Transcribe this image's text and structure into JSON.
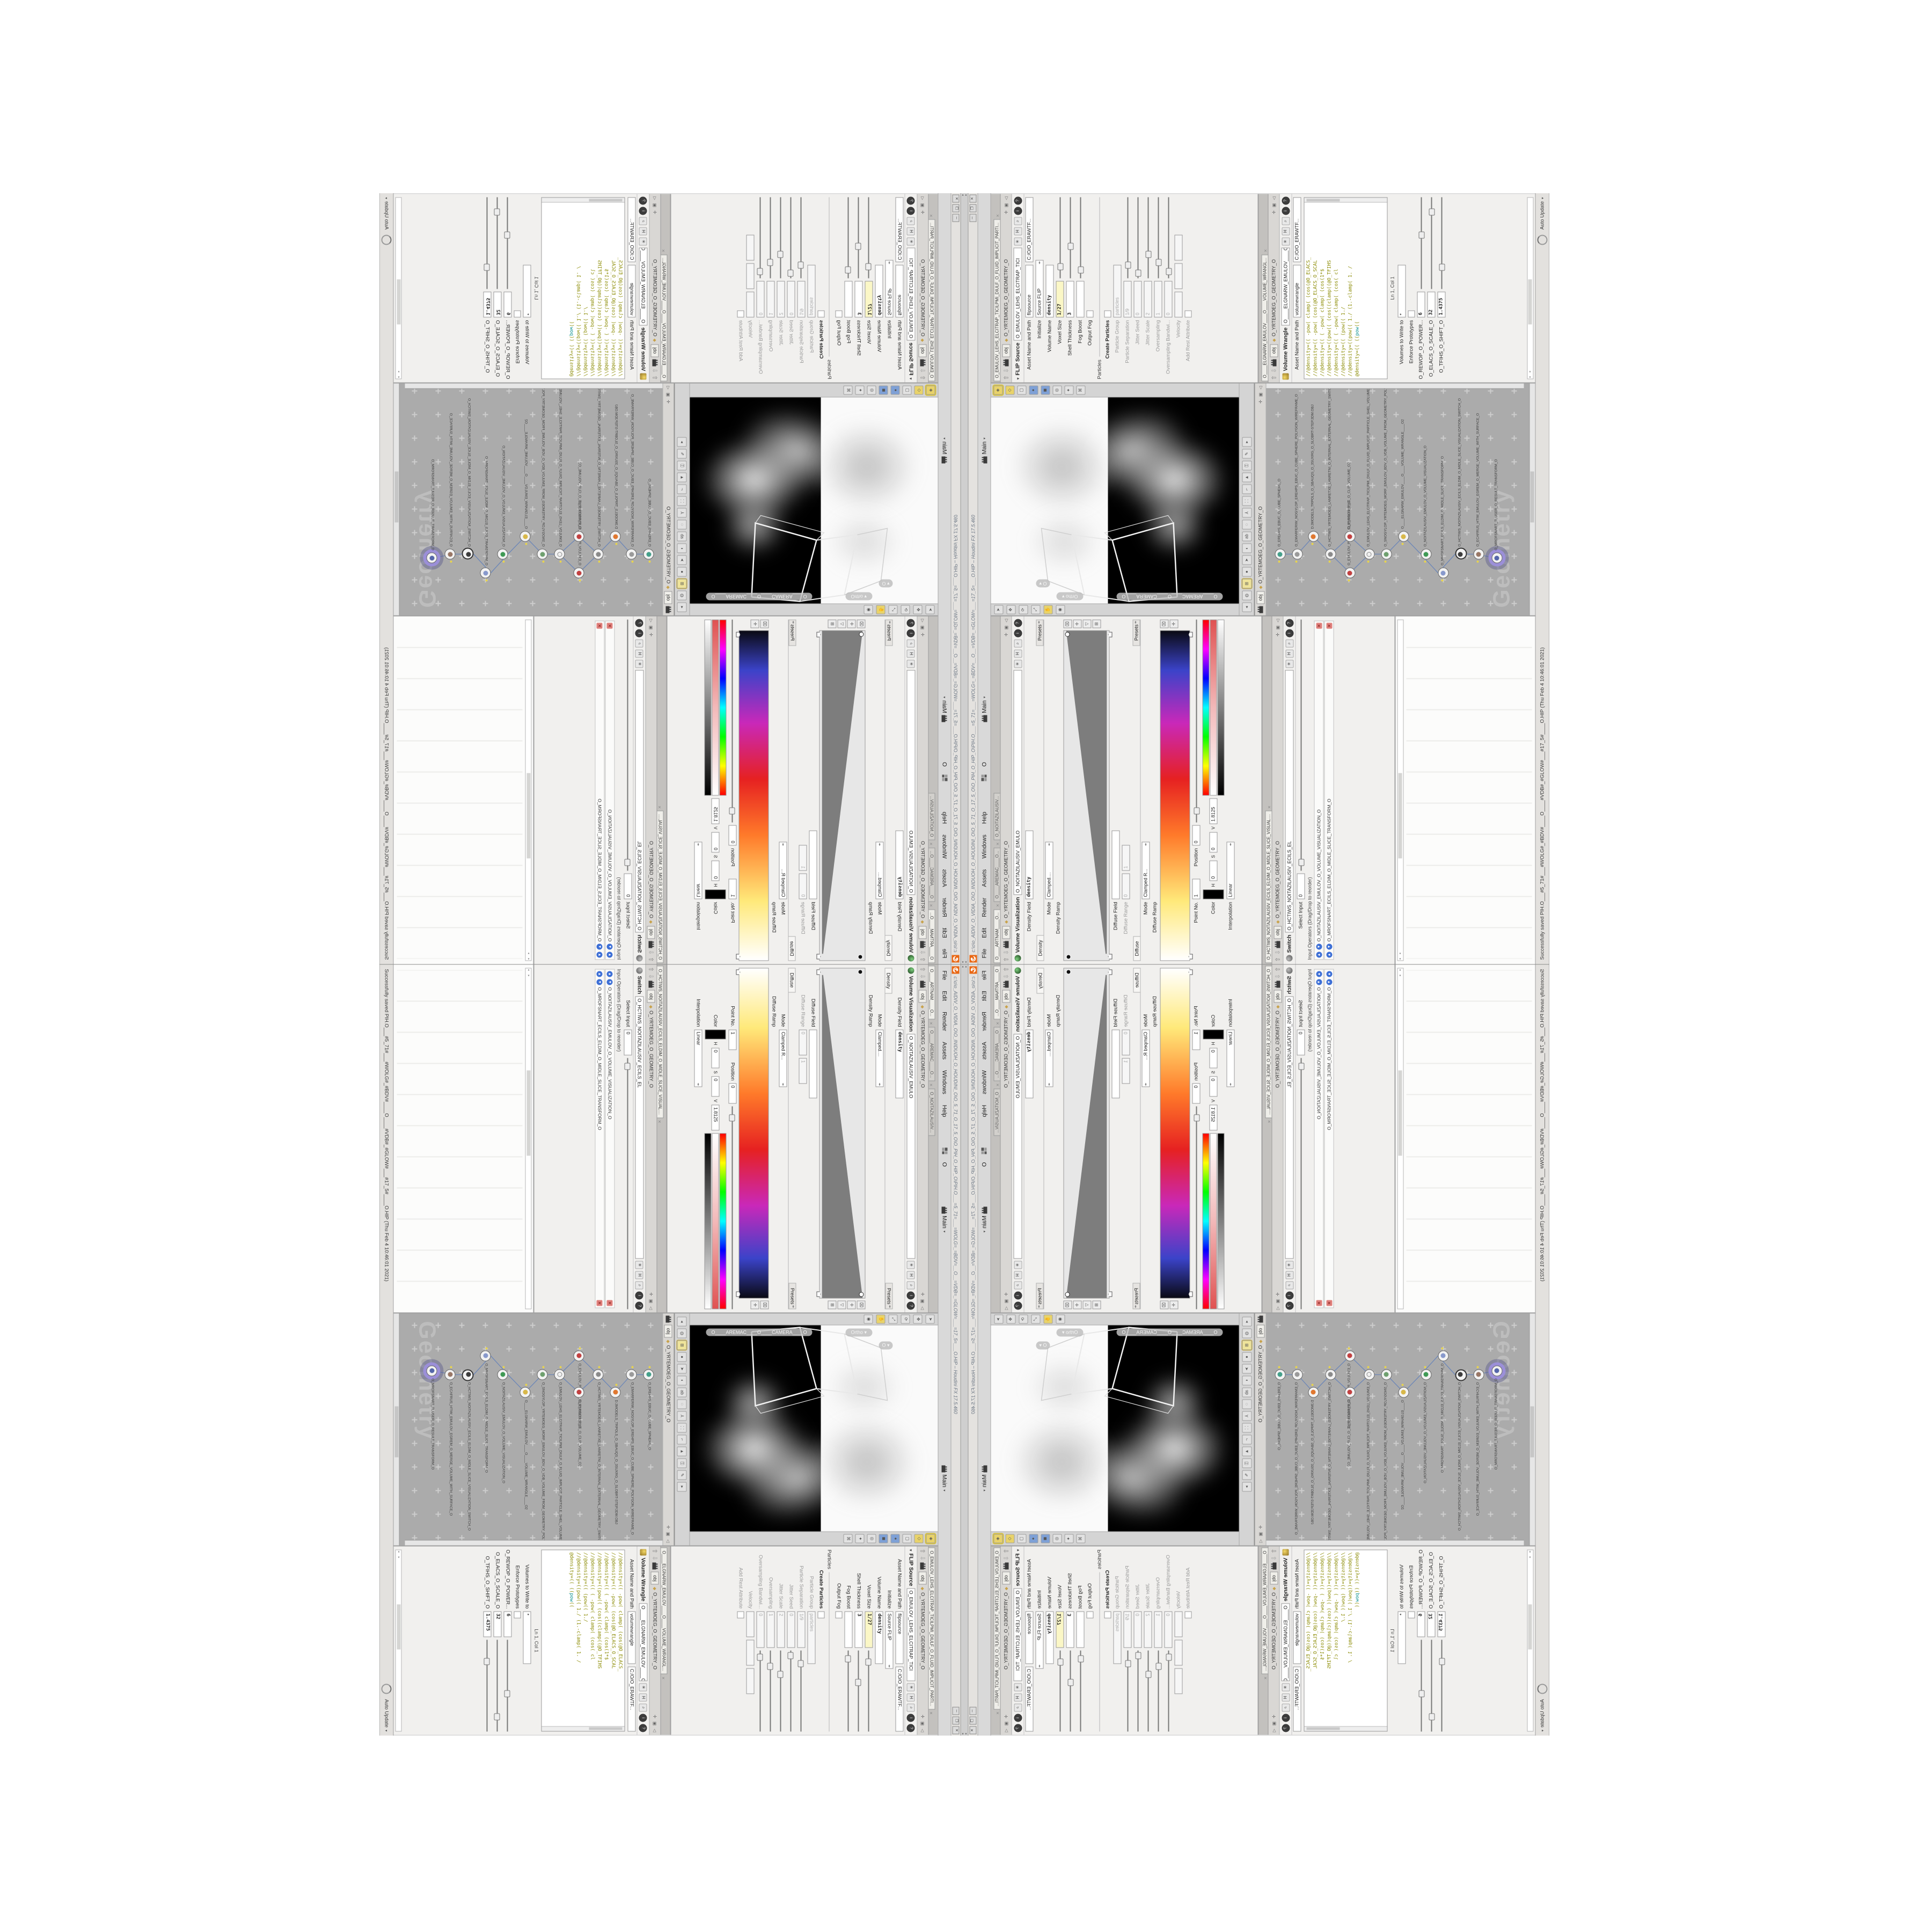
{
  "colors": {
    "accent_orange": "#e96713",
    "selected_node_purple": "#9b8fd8",
    "flag_yellow": "#e8d44d",
    "code_olive": "#8a8a00",
    "code_keyword_teal": "#008b8b",
    "expression_field_yellow": "#fbf7c6",
    "panel_gray": "#d9d9d9",
    "network_bg": "#ababab"
  },
  "window": {
    "title": "c:\\o\\o_AIDIV_O_VIDIA_O\\O_INIDUOH_O_HOUDINI_O\\O_5_71_O_17_5_O\\O_PIH_O_HIP_O\\PIH.O___=5_71=___=WOLG=_=BDV=__O__=VDB=_=GLOW=___=17_5=___O.HIP – Houdini FX 17.5.460",
    "menus": [
      "File",
      "Edit",
      "Render",
      "Assets",
      "Windows",
      "Help"
    ],
    "grid_label": "O",
    "desktop_label": "Main",
    "win_min": "─",
    "win_max": "❐",
    "win_close": "✕"
  },
  "status": {
    "message": "Successfully saved PIH.O___#5_71#___#WOLG#_#BDV#____O____#VDB#_#GLOW#___#17_5#____O.HIP (Thu Feb 4 10:46:01 2021)",
    "auto_update": "Auto Update"
  },
  "breadcrumb": {
    "root": "obj",
    "path": "O_YRTEMOEG_O_GEOMETRY_O"
  },
  "left_tabs": {
    "tab1": "O____ARTNAM____O...",
    "tab2": "O____AREMAC____O...",
    "tab3": "O_NOITAZILAUSIV..."
  },
  "volvis": {
    "title": "Volume Visualization",
    "name": "O_NOITAZILAUSIV_EMULO",
    "density_field_label": "Density Field",
    "density_field": "density",
    "mode_label": "Mode",
    "mode": "Clamped....",
    "folder_density": "Density",
    "folder_diffuse": "Diffuse",
    "presets": "Presets",
    "density_ramp_label": "Density Ramp",
    "diffuse_field_label": "Diffuse Field",
    "diffuse_field": "",
    "diffuse_range_label": "Diffuse Range",
    "range_min": "0",
    "range_max": "1",
    "mode2": "Clamped R...",
    "diffuse_ramp_label": "Diffuse Ramp",
    "point_label": "Point No.",
    "point": "1",
    "position_label": "Position",
    "position": "0",
    "color_label": "Color",
    "h_label": "H",
    "h": "0",
    "s_label": "S",
    "s": "0",
    "v_label": "V",
    "v": "1.8125",
    "interp_label": "Interpolation",
    "interp": "Linear"
  },
  "switch_pane": {
    "tab": "O_HCTIWS_NOITAZILAUSIV_ECILS_ELDIM_O_MIDLE_SLICE_VISUAL....",
    "title": "Switch",
    "name": "O_HCTIWS_NOITAZILAUSIV_ECILS_EL",
    "select_label": "Select Input",
    "select_value": "0",
    "list_header": "Input Operators (Drag/Drop to reorder)",
    "item1": "O_NOITAZILAUSIV_EMULOV_O_VOLUME_VISUALIZATION_O",
    "item2": "O_MROFSNART_ECILS_ELDIM_O_MIDLE_SLICE_TRANSFORM_O"
  },
  "flip": {
    "tab": "O_EMULOV_LEHS_ELCITRAP_TICILPMI_DIULF_O_FLUID_IMPLICIT_PARTI...",
    "title": "FLIP Source",
    "name": "O_EMULOV_LEHS_ELCITRAP_TICI",
    "asset_label": "Asset Name and Path",
    "node_name": "flipsource",
    "path": "C:/O/O_ERAWTF...",
    "initialize_label": "Initialize",
    "initialize": "Source FLIP",
    "volume_name_label": "Volume Name",
    "volume_name": "density",
    "voxel_label": "Voxel Size",
    "voxel": "1/27",
    "shell_label": "Shell Thickness",
    "shell": "3",
    "fog_label": "Fog Boost",
    "fog": "",
    "output_fog_label": "Output Fog",
    "particles_section": "Particles",
    "create_particles_label": "Create Particles",
    "group_label": "Particle Group",
    "group": "particles",
    "sep_label": "Particle Separation",
    "sep": "1/9",
    "jseed_label": "Jitter Seed",
    "jseed": "0",
    "jscale_label": "Jitter Scale",
    "jscale": "2",
    "over_label": "Oversampling",
    "over": "1",
    "overb_label": "Oversampling Bandwi...",
    "overb": "0",
    "velocity_label": "Velocity",
    "rest_label": "Add Rest Attribute"
  },
  "wrangle": {
    "tab": "O____ELGNARW_EMULOV____O____VOLUME_WRANGL...",
    "title": "Volume Wrangle",
    "name": "O____ELGNARW_EMULOV____O",
    "asset_label": "Asset Name and Path",
    "node_name": "volumewrangle",
    "path": "C:/O/O_ERAWTF...",
    "code": [
      "//@density=((      -pow(   clamp(  (cos(@O_ELACS_",
      "//@density=((      -pow(        (cos(@O_ELACS_O_SCAL",
      "//@density=((   (  -pow(   clamp(  (cos(1*$",
      "//@density=((pow((      (cos((clamp((@O_TFIHS",
      "//@density=((   (  -pow(   clamp(   (cos( cl",
      "//@density=((            (pow((        1./",
      "//@density=((pow((   1./ (1.-clamp(      1. /"
    ],
    "code_active_pre": "@density=((  ((",
    "code_active_kw": "pow",
    "code_active_post": "((",
    "cursor_pos": "Ln 1, Col 1",
    "volumes_label": "Volumes to Write to",
    "volumes": "*",
    "enforce_label": "Enforce Prototypes",
    "power_label": "O_REWOP_O_POWER...",
    "power": "6",
    "scale_label": "O_ELACS_O_SCALE_O",
    "scale": "32",
    "shift_label": "O_TFIHS_O_SHIFT_O",
    "shift": "1.4375"
  },
  "viewport": {
    "camera_pill": "O____AREMAC____O____CAMERA____O",
    "ortho_pill": "Ortho ▾",
    "mini_pill": "O ▾"
  },
  "network": {
    "watermark": "Geometry",
    "nodes": [
      {
        "type": "an_CubeSphere",
        "label": "O_EREHPS_EBUC_O_CUBE_SPHERE_O",
        "color": "#44a08a"
      },
      {
        "type": "PolyWire",
        "label": "O_EMARFERIW_NOGYLOP_EREHPS_EBUC_O_CUBE_SPHERE_POLYGON_WIREFRAME_O",
        "color": "#9a9a9a"
      },
      {
        "type": "File",
        "label": "D.3MODELS_TRPOLS_O_SBAUQS_O_3SUXRG_O_SLOBRT-STEP.3DM.OBJ",
        "color": "#e07830"
      },
      {
        "type": "Switch",
        "label": "O_HCTIWS_YRTEMOEG_LANRETXE_LANRETNI_O_INTERNAL_EXTERNAL_GEOMETRY_SWITCH_O",
        "color": "#8a8a8a"
      },
      {
        "type": "Clip",
        "label": "O_EMULOV_PILC_O_CLIP_VOLUME_O",
        "color": "#c24040"
      },
      {
        "type": "Clip",
        "label": "O_EMULOV_PILC_O_CLIP_VOLUME_O2",
        "color": "#c24040"
      },
      {
        "type": "FLIP Source",
        "label": "O_EMULOV_LEHS_ELCITRAP_TICILPMI_DIULF_O_FLUID_IMPLICIT_PARTICLE_SHEL_VOLUME_O",
        "color": "#f0f0f0"
      },
      {
        "type": "VDB from Polygons",
        "label": "O_SNOGYLOP_YRTEMOEG_MORF_EMULOV_BDV_O_VDB_VOLUME_FROM_GEOMETRY_POLYGONS_O",
        "color": "#6fa06f"
      },
      {
        "type": "Volume Wrangle",
        "label": "O____ELGNARW_EMULOV____O____VOLUME_WRANGLE____O2",
        "color": "#d8b84a"
      },
      {
        "type": "Volume Visualization",
        "label": "O_NOITAZILAUSIV_EMULOV_O_VOLUME_VISUALIZATION_O",
        "color": "#3f9a55"
      },
      {
        "type": "Transform",
        "label": "O_MROFSNART_ECILS_ELDIM_O_MIDLE_SLICE_TRANSFORM_O",
        "color": "#8899cc"
      },
      {
        "type": "Switch",
        "label": "O_HCTIWS_NOITAZILAUSIV_ECILS_ELDIM_O_MIDLE_SLICE_VISUALIZATION_SWITCH_O",
        "color": "#3c3c3c"
      },
      {
        "type": "Merge",
        "label": "O_ECAFRUS_HTIW_EMULOV_EGREM_O_MERGE_VOLUME_WITH_SURFACE_O",
        "color": "#997766"
      },
      {
        "type": "Transform",
        "label": "O_MROFSNART_TLUSER_O_RESULT_TRANSFORM_O",
        "color": "#5566aa"
      }
    ]
  }
}
